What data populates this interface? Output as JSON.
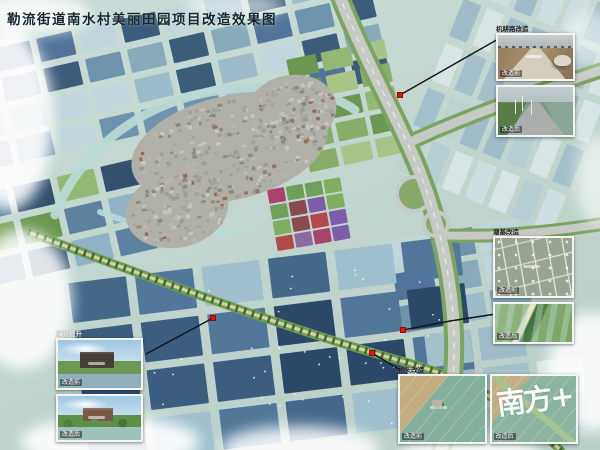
{
  "title": "勒流街道南水村美丽田园项目改造效果图",
  "panels": {
    "farm_road": {
      "heading": "机耕路改造",
      "before": "改造前",
      "after": "改造后"
    },
    "pond_dike": {
      "heading": "塘基改造",
      "before": "改造前",
      "after": "改造后"
    },
    "greening": {
      "heading": "绿化提升",
      "before": "改造前",
      "after": "改造后"
    },
    "bridge_head": {
      "heading": "桥头改造",
      "before": "改造前",
      "after": "改造后",
      "watermark": "南方+"
    }
  },
  "colors": {
    "marker_red": "#e8150d",
    "connector": "#141414",
    "title_text": "#182830"
  }
}
